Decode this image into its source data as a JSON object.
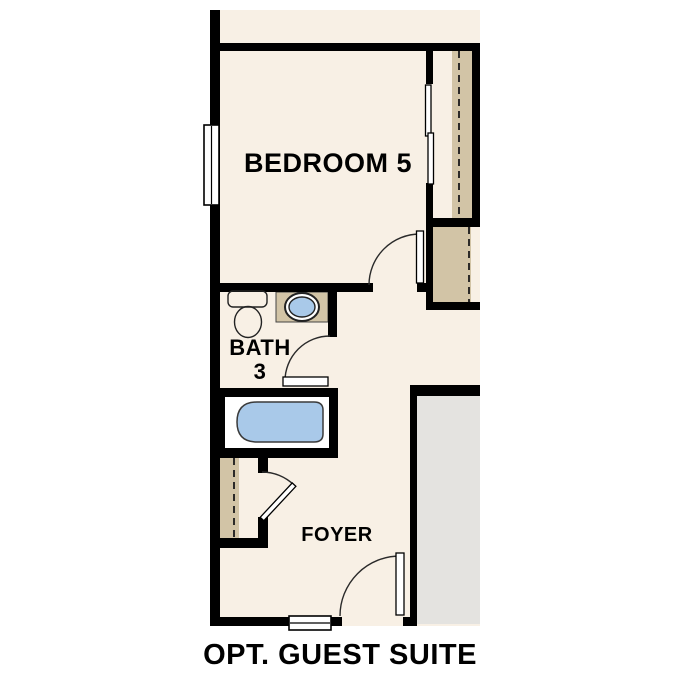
{
  "plan": {
    "caption": "OPT. GUEST SUITE",
    "rooms": {
      "bedroom": {
        "label": "BEDROOM 5"
      },
      "bath": {
        "label": "BATH",
        "number": "3"
      },
      "foyer": {
        "label": "FOYER"
      }
    },
    "fixtures": [
      "toilet",
      "sink",
      "bathtub"
    ],
    "features": [
      "bedroom-window",
      "entry-window",
      "closet-shelving-dashed",
      "sliding-closet-doors",
      "hinged-door-swings"
    ]
  },
  "colors": {
    "background": "#ffffff",
    "floor": "#f8f0e5",
    "wall": "#000000",
    "shelf": "#d2c4a6",
    "fixture_water": "#a9c9e9",
    "exterior": "#e4e3e0",
    "label_text": "#000000"
  }
}
